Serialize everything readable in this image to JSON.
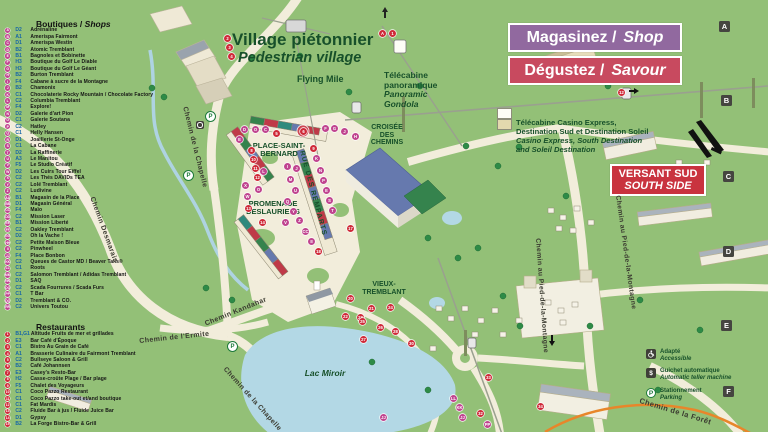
{
  "banners": {
    "shop_fr": "Magasinez /",
    "shop_en": "Shop",
    "savour_fr": "Dégustez /",
    "savour_en": "Savour",
    "versant_fr": "VERSANT SUD",
    "versant_en": "SOUTH SIDE"
  },
  "shops": {
    "title_fr": "Boutiques /",
    "title_en": "Shops",
    "items": [
      {
        "m": "A",
        "code": "D2",
        "name": "Adrénaline"
      },
      {
        "m": "B",
        "code": "A1",
        "name": "Amerispa Fairmont"
      },
      {
        "m": "C",
        "code": "D1",
        "name": "Amerispa Westin"
      },
      {
        "m": "D",
        "code": "B2",
        "name": "Atomic Tremblant"
      },
      {
        "m": "E",
        "code": "B1",
        "name": "Bagnoles et Bobinette"
      },
      {
        "m": "F",
        "code": "H3",
        "name": "Boutique du Golf Le Diable"
      },
      {
        "m": "G",
        "code": "H3",
        "name": "Boutique du Golf Le Géant"
      },
      {
        "m": "H",
        "code": "B2",
        "name": "Burton Tremblant"
      },
      {
        "m": "I",
        "code": "F4",
        "name": "Cabane à sucre de la Montagne"
      },
      {
        "m": "J",
        "code": "B2",
        "name": "Chamonix"
      },
      {
        "m": "K",
        "code": "C1",
        "name": "Chocolaterie Rocky Mountain / Chocolate Factory"
      },
      {
        "m": "L",
        "code": "C2",
        "name": "Columbia Tremblant"
      },
      {
        "m": "M",
        "code": "F4",
        "name": "Explore!"
      },
      {
        "m": "N",
        "code": "D2",
        "name": "Galerie d'art Pion"
      },
      {
        "m": "O",
        "code": "C1",
        "name": "Galerie Soutana"
      },
      {
        "m": "P",
        "code": "C2",
        "name": "Hatley"
      },
      {
        "m": "Q",
        "code": "C1",
        "name": "Helly Hansen"
      },
      {
        "m": "R",
        "code": "D1",
        "name": "Joaillerie St-Onge"
      },
      {
        "m": "S",
        "code": "C1",
        "name": "La Cabane"
      },
      {
        "m": "T",
        "code": "D2",
        "name": "La Raffinerie"
      },
      {
        "m": "U",
        "code": "A3",
        "name": "Le Manitou"
      },
      {
        "m": "V",
        "code": "F5",
        "name": "Le Studio Créatif"
      },
      {
        "m": "W",
        "code": "D2",
        "name": "Les Cuirs Tour Eiffel"
      },
      {
        "m": "X",
        "code": "C2",
        "name": "Les Thés DAVIDs TEA"
      },
      {
        "m": "Y",
        "code": "C2",
        "name": "Lolë Tremblant"
      },
      {
        "m": "Z",
        "code": "C2",
        "name": "Ludivine"
      },
      {
        "m": "AA",
        "code": "B1",
        "name": "Magasin de la Place"
      },
      {
        "m": "BB",
        "code": "D1",
        "name": "Magasin Général"
      },
      {
        "m": "CC",
        "code": "F4",
        "name": "Maïo"
      },
      {
        "m": "DD",
        "code": "C2",
        "name": "Mission Laser"
      },
      {
        "m": "EE",
        "code": "B1",
        "name": "Mission Liberté"
      },
      {
        "m": "FF",
        "code": "C2",
        "name": "Oakley Tremblant"
      },
      {
        "m": "GG",
        "code": "D2",
        "name": "Oh la Vache !"
      },
      {
        "m": "HH",
        "code": "C2",
        "name": "Petite Maison Bleue"
      },
      {
        "m": "II",
        "code": "C2",
        "name": "Pinwheel"
      },
      {
        "m": "JJ",
        "code": "F4",
        "name": "Place Bonbon"
      },
      {
        "m": "KK",
        "code": "C2",
        "name": "Queues de Castor MD / Beaver Tails®"
      },
      {
        "m": "LL",
        "code": "C1",
        "name": "Roots"
      },
      {
        "m": "MM",
        "code": "C2",
        "name": "Salomon Tremblant / Adidas Tremblant"
      },
      {
        "m": "NN",
        "code": "D1",
        "name": "SAQ"
      },
      {
        "m": "OO",
        "code": "C2",
        "name": "Scada Fourrures / Scada Furs"
      },
      {
        "m": "PP",
        "code": "C1",
        "name": "T Bar"
      },
      {
        "m": "QQ",
        "code": "D2",
        "name": "Tremblant & CO."
      },
      {
        "m": "RR",
        "code": "C2",
        "name": "Univers Toutou"
      }
    ]
  },
  "restaurants": {
    "title": "Restaurants",
    "items": [
      {
        "m": "1",
        "code": "B1,G1",
        "name": "Altitude Fruits de mer et grillades"
      },
      {
        "m": "2",
        "code": "E3",
        "name": "Bar Café d'Époque"
      },
      {
        "m": "3",
        "code": "C1",
        "name": "Bistro Au Grain de Café"
      },
      {
        "m": "4",
        "code": "A1",
        "name": "Brasserie Culinaire du Fairmont Tremblant"
      },
      {
        "m": "5",
        "code": "C2",
        "name": "Bullseye Saloon & Grill"
      },
      {
        "m": "6",
        "code": "B2",
        "name": "Café Johannsen"
      },
      {
        "m": "7",
        "code": "E3",
        "name": "Casey's Resto-Bar"
      },
      {
        "m": "8",
        "code": "H2",
        "name": "Casse-croûte Plage / Bar plage"
      },
      {
        "m": "9",
        "code": "F5",
        "name": "Chalet des Voyageurs"
      },
      {
        "m": "10",
        "code": "C1",
        "name": "Coco Pazzo Restaurant"
      },
      {
        "m": "11",
        "code": "C1",
        "name": "Coco Pazzo take-out et/and boutique"
      },
      {
        "m": "12",
        "code": "C1",
        "name": "Fat Mardis"
      },
      {
        "m": "13",
        "code": "C2",
        "name": "Fluide Bar à jus / Fluide Juice Bar"
      },
      {
        "m": "14",
        "code": "D1",
        "name": "Gypsy"
      },
      {
        "m": "15",
        "code": "B2",
        "name": "La Forge Bistro-Bar & Grill"
      }
    ]
  },
  "gondola_note": {
    "line1": "Télécabine Casino Express,",
    "line2": "Destination Sud et Destination Soleil",
    "line3": "Casino Express, South Destination",
    "line4": "and Soleil Destination"
  },
  "map_labels": {
    "village_fr": "Village piétonnier",
    "village_en": "Pedestrian village",
    "flying_mile": "Flying Mile",
    "pano_l1": "Télécabine",
    "pano_l2": "panoramique",
    "pano_l3": "Panoramic",
    "pano_l4": "Gondola",
    "croisee": "CROISÉE DES CHEMINS",
    "place": "PLACE-SAINT-BERNARD",
    "promenade": "PROMENADE DESLAURIERS",
    "remparts": "RUE DES REMPARTS",
    "vieux": "VIEUX-TREMBLANT",
    "lac": "Lac Miroir",
    "kandahar": "Chemin Kandahar",
    "chapelle": "Chemin de la Chapelle",
    "chapelle2": "Chemin de la Chapelle",
    "desmarais": "Chemin Desmarais",
    "ermite": "Chemin de l'Ermite",
    "foret": "Chemin de la Forêt",
    "pied1": "Chemin au Pied-de-la-Montagne",
    "pied2": "Chemin au Pied-de-la-Montagne"
  },
  "amenities": [
    {
      "icon": "wheelchair-icon",
      "fr": "Adapté",
      "en": "Accessible"
    },
    {
      "icon": "atm-icon",
      "fr": "Guichet automatique",
      "en": "Automatic teller machine"
    },
    {
      "icon": "parking-icon",
      "fr": "Stationnement",
      "en": "Parking"
    }
  ],
  "grid_letters": [
    {
      "label": "A",
      "x": 719,
      "y": 21
    },
    {
      "label": "B",
      "x": 721,
      "y": 95
    },
    {
      "label": "C",
      "x": 723,
      "y": 171
    },
    {
      "label": "D",
      "x": 723,
      "y": 246
    },
    {
      "label": "E",
      "x": 721,
      "y": 320
    },
    {
      "label": "F",
      "x": 723,
      "y": 386
    }
  ],
  "map_markers": [
    {
      "x": 379,
      "y": 30,
      "label": "A",
      "kind": "red"
    },
    {
      "x": 389,
      "y": 30,
      "label": "1",
      "kind": "red"
    },
    {
      "x": 224,
      "y": 35,
      "label": "2",
      "kind": "red"
    },
    {
      "x": 226,
      "y": 44,
      "label": "3",
      "kind": "red"
    },
    {
      "x": 228,
      "y": 53,
      "label": "4",
      "kind": "red"
    },
    {
      "x": 241,
      "y": 126,
      "label": "D",
      "kind": "pink"
    },
    {
      "x": 252,
      "y": 126,
      "label": "O",
      "kind": "pink"
    },
    {
      "x": 262,
      "y": 126,
      "label": "C",
      "kind": "pink"
    },
    {
      "x": 236,
      "y": 136,
      "label": "E",
      "kind": "pink"
    },
    {
      "x": 273,
      "y": 130,
      "label": "5",
      "kind": "red"
    },
    {
      "x": 300,
      "y": 128,
      "label": "6",
      "kind": "red"
    },
    {
      "x": 322,
      "y": 125,
      "label": "F",
      "kind": "pink"
    },
    {
      "x": 331,
      "y": 125,
      "label": "G",
      "kind": "pink"
    },
    {
      "x": 341,
      "y": 128,
      "label": "J",
      "kind": "pink"
    },
    {
      "x": 352,
      "y": 133,
      "label": "H",
      "kind": "pink"
    },
    {
      "x": 310,
      "y": 145,
      "label": "9",
      "kind": "red"
    },
    {
      "x": 248,
      "y": 147,
      "label": "8",
      "kind": "red"
    },
    {
      "x": 250,
      "y": 156,
      "label": "10",
      "kind": "red"
    },
    {
      "x": 252,
      "y": 165,
      "label": "11",
      "kind": "red"
    },
    {
      "x": 254,
      "y": 174,
      "label": "12",
      "kind": "red"
    },
    {
      "x": 284,
      "y": 163,
      "label": "I",
      "kind": "pink"
    },
    {
      "x": 293,
      "y": 165,
      "label": "J",
      "kind": "pink"
    },
    {
      "x": 260,
      "y": 168,
      "label": "L",
      "kind": "pink"
    },
    {
      "x": 287,
      "y": 176,
      "label": "M",
      "kind": "pink"
    },
    {
      "x": 255,
      "y": 186,
      "label": "O",
      "kind": "pink"
    },
    {
      "x": 292,
      "y": 187,
      "label": "U",
      "kind": "pink"
    },
    {
      "x": 284,
      "y": 198,
      "label": "Q",
      "kind": "pink"
    },
    {
      "x": 290,
      "y": 208,
      "label": "Y",
      "kind": "pink"
    },
    {
      "x": 296,
      "y": 217,
      "label": "Z",
      "kind": "pink"
    },
    {
      "x": 282,
      "y": 219,
      "label": "V",
      "kind": "pink"
    },
    {
      "x": 242,
      "y": 182,
      "label": "X",
      "kind": "pink"
    },
    {
      "x": 244,
      "y": 193,
      "label": "W",
      "kind": "pink"
    },
    {
      "x": 245,
      "y": 205,
      "label": "13",
      "kind": "red"
    },
    {
      "x": 259,
      "y": 219,
      "label": "14",
      "kind": "red"
    },
    {
      "x": 313,
      "y": 155,
      "label": "K",
      "kind": "pink"
    },
    {
      "x": 317,
      "y": 167,
      "label": "N",
      "kind": "pink"
    },
    {
      "x": 320,
      "y": 177,
      "label": "P",
      "kind": "pink"
    },
    {
      "x": 323,
      "y": 187,
      "label": "E",
      "kind": "pink"
    },
    {
      "x": 326,
      "y": 197,
      "label": "S",
      "kind": "pink"
    },
    {
      "x": 329,
      "y": 207,
      "label": "T",
      "kind": "pink"
    },
    {
      "x": 302,
      "y": 228,
      "label": "CC",
      "kind": "pink"
    },
    {
      "x": 308,
      "y": 238,
      "label": "II",
      "kind": "pink"
    },
    {
      "x": 315,
      "y": 248,
      "label": "18",
      "kind": "red"
    },
    {
      "x": 347,
      "y": 225,
      "label": "17",
      "kind": "red"
    },
    {
      "x": 347,
      "y": 295,
      "label": "20",
      "kind": "red"
    },
    {
      "x": 368,
      "y": 305,
      "label": "21",
      "kind": "red"
    },
    {
      "x": 342,
      "y": 313,
      "label": "22",
      "kind": "red"
    },
    {
      "x": 357,
      "y": 314,
      "label": "23",
      "kind": "red"
    },
    {
      "x": 387,
      "y": 304,
      "label": "24",
      "kind": "red"
    },
    {
      "x": 359,
      "y": 318,
      "label": "25",
      "kind": "red"
    },
    {
      "x": 377,
      "y": 324,
      "label": "26",
      "kind": "red"
    },
    {
      "x": 360,
      "y": 336,
      "label": "27",
      "kind": "red"
    },
    {
      "x": 392,
      "y": 328,
      "label": "28",
      "kind": "red"
    },
    {
      "x": 408,
      "y": 340,
      "label": "30",
      "kind": "red"
    },
    {
      "x": 618,
      "y": 89,
      "label": "12",
      "kind": "red"
    },
    {
      "x": 450,
      "y": 395,
      "label": "LL",
      "kind": "pink"
    },
    {
      "x": 456,
      "y": 404,
      "label": "KK",
      "kind": "pink"
    },
    {
      "x": 459,
      "y": 414,
      "label": "JJ",
      "kind": "pink"
    },
    {
      "x": 484,
      "y": 421,
      "label": "PP",
      "kind": "pink"
    },
    {
      "x": 477,
      "y": 410,
      "label": "32",
      "kind": "red"
    },
    {
      "x": 485,
      "y": 374,
      "label": "33",
      "kind": "red"
    },
    {
      "x": 537,
      "y": 403,
      "label": "34",
      "kind": "red"
    },
    {
      "x": 380,
      "y": 414,
      "label": "JJ",
      "kind": "pink"
    },
    {
      "x": 205,
      "y": 111,
      "label": "P",
      "kind": "parking"
    },
    {
      "x": 183,
      "y": 170,
      "label": "P",
      "kind": "parking"
    },
    {
      "x": 227,
      "y": 341,
      "label": "P",
      "kind": "parking"
    },
    {
      "x": 196,
      "y": 121,
      "label": "",
      "kind": "access"
    }
  ],
  "colors": {
    "map_green": "#93c077",
    "road_cream": "#f2eddb",
    "water": "#b3d8e5",
    "banner_purple": "#91699f",
    "banner_red": "#c84a5f",
    "versant_red": "#c9333f",
    "marker_pink": "#c0448f",
    "marker_red": "#cf2a39",
    "code_blue": "#1565a8",
    "label_green": "#17502a"
  }
}
